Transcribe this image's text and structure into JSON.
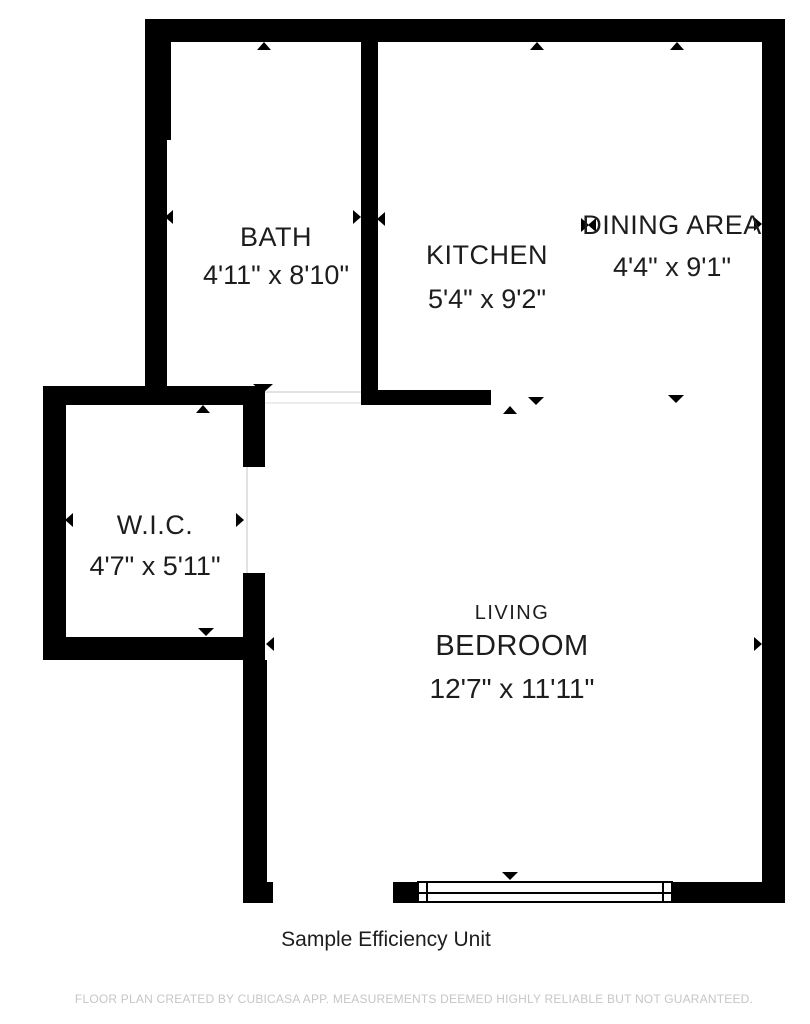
{
  "caption": "Sample Efficiency Unit",
  "disclaimer": "FLOOR PLAN CREATED BY CUBICASA APP. MEASUREMENTS DEEMED HIGHLY RELIABLE BUT NOT GUARANTEED.",
  "rooms": {
    "bath": {
      "name": "BATH",
      "dimensions": "4'11\" x 8'10\""
    },
    "kitchen": {
      "name": "KITCHEN",
      "dimensions": "5'4\" x 9'2\""
    },
    "dining_area": {
      "name": "DINING AREA",
      "dimensions": "4'4\" x 9'1\""
    },
    "wic": {
      "name": "W.I.C.",
      "dimensions": "4'7\" x 5'11\""
    },
    "living_bedroom": {
      "name_line1": "LIVING",
      "name_line2": "BEDROOM",
      "dimensions": "12'7\" x 11'11\""
    }
  },
  "colors": {
    "wall": "#000000",
    "text": "#1d1d1d",
    "disclaimer_text": "#c6c6c6",
    "background": "#ffffff"
  }
}
